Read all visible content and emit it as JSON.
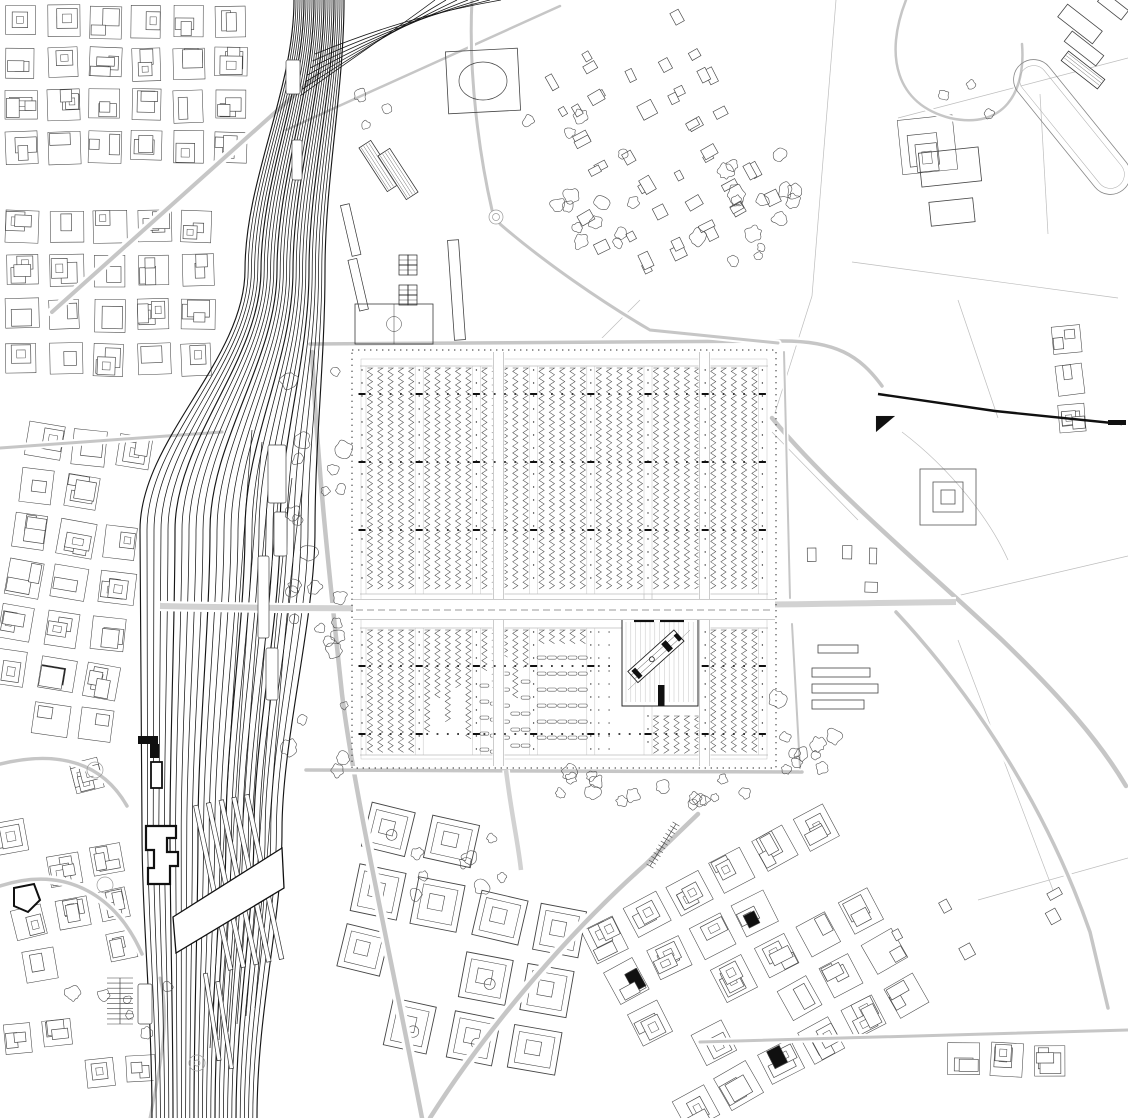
{
  "canvas": {
    "width": 1128,
    "height": 1118
  },
  "colors": {
    "background": "#ffffff",
    "ink": "#101010",
    "fabric": "#454545",
    "light": "#9a9a9a",
    "faint": "#bdbdbd",
    "road": "#c6c6c6",
    "band": "#d2d2d2",
    "rail": "#161616",
    "tree": "#4f4f4f",
    "strip": "#4a4a4a",
    "dot": "#2e2e2e"
  },
  "fields": [
    "M836,0 L812,296",
    "M812,296 L774,416",
    "M898,118 L1128,58",
    "M852,262 L1118,298",
    "M958,300 L998,418",
    "M948,598 L1128,556",
    "M958,640 L1056,898",
    "M978,900 L1128,858",
    "M1040,94 L1048,234",
    "M902,432 C952,470 990,520 1008,560",
    "M772,432 L858,520",
    "M600,340 L640,300",
    "M860,600 L948,598"
  ],
  "districts": [
    {
      "x": 0,
      "y": 0,
      "w": 285,
      "h": 200,
      "cell": 42,
      "gap": 9,
      "rot": 0,
      "seed": 11,
      "density": 0.96,
      "style": "block"
    },
    {
      "x": 0,
      "y": 205,
      "w": 240,
      "h": 215,
      "cell": 44,
      "gap": 10,
      "rot": 0,
      "seed": 22,
      "density": 0.94,
      "style": "block"
    },
    {
      "x": 0,
      "y": 425,
      "w": 175,
      "h": 330,
      "cell": 46,
      "gap": 10,
      "rot": 8,
      "seed": 33,
      "density": 0.95,
      "style": "block"
    },
    {
      "x": 0,
      "y": 758,
      "w": 148,
      "h": 250,
      "cell": 44,
      "gap": 12,
      "rot": -12,
      "seed": 44,
      "density": 0.72,
      "style": "block"
    },
    {
      "x": 0,
      "y": 1012,
      "w": 190,
      "h": 106,
      "cell": 40,
      "gap": 10,
      "rot": -4,
      "seed": 55,
      "density": 0.6,
      "style": "block"
    },
    {
      "x": 332,
      "y": 822,
      "w": 300,
      "h": 296,
      "cell": 62,
      "gap": 14,
      "rot": 12,
      "seed": 66,
      "density": 0.85,
      "style": "campus"
    },
    {
      "x": 620,
      "y": 842,
      "w": 300,
      "h": 276,
      "cell": 48,
      "gap": 11,
      "rot": -28,
      "seed": 77,
      "density": 0.8,
      "style": "block"
    },
    {
      "x": 548,
      "y": 26,
      "w": 214,
      "h": 252,
      "cell": 34,
      "gap": 9,
      "rot": -28,
      "seed": 88,
      "density": 0.8,
      "style": "houses"
    },
    {
      "x": 880,
      "y": 858,
      "w": 248,
      "h": 152,
      "cell": 52,
      "gap": 12,
      "rot": -30,
      "seed": 99,
      "density": 0.45,
      "style": "houses"
    },
    {
      "x": 896,
      "y": 1038,
      "w": 232,
      "h": 80,
      "cell": 44,
      "gap": 10,
      "rot": 2,
      "seed": 111,
      "density": 0.8,
      "style": "block"
    },
    {
      "x": 1052,
      "y": 318,
      "w": 76,
      "h": 152,
      "cell": 40,
      "gap": 9,
      "rot": -5,
      "seed": 122,
      "density": 0.85,
      "style": "block"
    },
    {
      "x": 822,
      "y": 40,
      "w": 162,
      "h": 262,
      "cell": 72,
      "gap": 16,
      "rot": -8,
      "seed": 133,
      "density": 0.5,
      "style": "block"
    },
    {
      "x": 800,
      "y": 540,
      "w": 92,
      "h": 70,
      "cell": 30,
      "gap": 8,
      "rot": 0,
      "seed": 144,
      "density": 0.6,
      "style": "houses"
    }
  ],
  "roads": [
    {
      "d": "M52,312 L318,74",
      "w": 4
    },
    {
      "d": "M310,344 L778,341 C836,340 860,356 882,386",
      "w": 3.5
    },
    {
      "d": "M312,352 C318,470 328,562 342,694 C354,792 392,962 422,1118",
      "w": 4.5
    },
    {
      "d": "M306,770 L802,772",
      "w": 3.5
    },
    {
      "d": "M772,418 C828,486 916,560 1002,640 C1062,698 1100,742 1126,786",
      "w": 4.5
    },
    {
      "d": "M896,612 C978,700 1048,812 1090,932 L1108,1008",
      "w": 3.5
    },
    {
      "d": "M430,1118 C478,1042 558,942 646,864 L698,814",
      "w": 4.5
    },
    {
      "d": "M560,6 L286,130",
      "w": 2.5
    },
    {
      "d": "M906,0 C884,56 896,104 950,118 C1004,130 1026,92 1022,44",
      "w": 2.5
    },
    {
      "d": "M500,224 C544,262 602,302 650,330 L778,343",
      "w": 3
    },
    {
      "d": "M492,210 C480,158 468,76 472,0",
      "w": 3
    },
    {
      "d": "M700,1042 L1128,1030",
      "w": 3
    },
    {
      "d": "M0,764 C58,750 102,762 127,806",
      "w": 3.5
    },
    {
      "d": "M0,886 C68,864 118,898 142,954",
      "w": 3.5
    },
    {
      "d": "M150,1118 C162,1058 170,1016 160,978",
      "w": 3
    },
    {
      "d": "M784,352 L790,598",
      "w": 2
    },
    {
      "d": "M792,624 L800,768",
      "w": 2
    },
    {
      "d": "M0,448 L222,432",
      "w": 3
    }
  ],
  "roads_overlay": [
    {
      "d": "M160,606 C420,612 700,605 956,602",
      "w": 6
    },
    {
      "d": "M506,770 C512,818 518,842 521,870",
      "w": 4.5
    }
  ],
  "railway": {
    "count": 26,
    "ys": [
      0,
      270,
      530,
      830,
      1118
    ],
    "x": [
      [
        294,
        2.0
      ],
      [
        245,
        3.2
      ],
      [
        140,
        7.0
      ],
      [
        142,
        5.6
      ],
      [
        152,
        4.2
      ]
    ],
    "branch_count": 7,
    "sidings": 6
  },
  "platforms": {
    "groups": [
      {
        "rot": -12,
        "cx": 240,
        "cy": 880,
        "rects": [
          [
            210,
            798,
            4.5,
            168
          ],
          [
            223,
            798,
            4.5,
            168
          ],
          [
            236,
            798,
            4.5,
            168
          ],
          [
            249,
            798,
            4.5,
            168
          ],
          [
            262,
            798,
            4.5,
            168
          ]
        ]
      },
      {
        "rot": -9,
        "cx": 218,
        "cy": 1015,
        "rects": [
          [
            210,
            972,
            4,
            88
          ],
          [
            221,
            982,
            4,
            88
          ]
        ]
      },
      {
        "rot": -13,
        "cx": 358,
        "cy": 255,
        "rects": [
          [
            352,
            203,
            9,
            52
          ],
          [
            347,
            258,
            9,
            52
          ]
        ]
      }
    ]
  },
  "station": {
    "outline": "M146,826 L176,826 L176,838 L167,838 L167,852 L178,852 L178,866 L170,866 L170,884 L148,884 L148,868 L154,868 L154,850 L146,850 Z",
    "black_rects": [
      [
        138,
        736,
        20,
        8
      ],
      [
        150,
        744,
        9,
        14
      ]
    ],
    "bar": [
      151,
      762,
      11,
      26
    ],
    "pentagon": "M14,888 L34,884 L40,900 L28,912 L14,906 Z"
  },
  "deck": {
    "poly": "M173,917 L282,848 L284,888 L176,953 Z"
  },
  "thin_buildings": [
    [
      268,
      445,
      18,
      58
    ],
    [
      274,
      512,
      13,
      44
    ],
    [
      258,
      556,
      11,
      82
    ],
    [
      266,
      648,
      12,
      52
    ],
    [
      286,
      60,
      14,
      34
    ],
    [
      292,
      140,
      10,
      40
    ],
    [
      138,
      984,
      14,
      40
    ]
  ],
  "site": {
    "border": {
      "x": 352,
      "y": 350,
      "w": 424,
      "h": 418
    },
    "inner": {
      "x": 361,
      "y": 359,
      "w": 406,
      "h": 400
    },
    "band": {
      "y0": 599,
      "y1": 620
    },
    "upper": {
      "y0": 366,
      "y1": 594,
      "markers": [
        394,
        462,
        530
      ]
    },
    "lower": {
      "y0": 628,
      "y1": 755,
      "markers": [
        666,
        734
      ]
    },
    "cols": {
      "start": 370,
      "period": 57.2,
      "per": 5,
      "gap": 10.3
    },
    "lanes": [
      493,
      699
    ],
    "lower_groups": [
      "full",
      "stagger",
      "short",
      "beds",
      "dots",
      "plot",
      "full"
    ],
    "stagger_ends": [
      735,
      698,
      722,
      688,
      742
    ],
    "short_ends": [
      672,
      690,
      660,
      700,
      668
    ],
    "plot": {
      "x": 622,
      "y": 618,
      "w": 76,
      "h": 88,
      "bars_top": [
        [
          634,
          618.5,
          20,
          3.6
        ],
        [
          660,
          618.5,
          24,
          3.6
        ]
      ],
      "bar_bottom": [
        658,
        685,
        6.5,
        21
      ],
      "line_step": 4.8,
      "diag": {
        "rot": -42,
        "cx": 657,
        "cy": 656,
        "rect": [
          625,
          648,
          62,
          15
        ],
        "blacks": [
          [
            628,
            650,
            5,
            11
          ],
          [
            668,
            650,
            6,
            11
          ],
          [
            683,
            652,
            4,
            8
          ]
        ],
        "circle": [
          651,
          655,
          2.5
        ]
      }
    }
  },
  "trees": [
    {
      "x": 288,
      "y": 355,
      "w": 58,
      "h": 416,
      "n": 26,
      "r0": 4,
      "r1": 9,
      "seed": 7
    },
    {
      "x": 520,
      "y": 772,
      "w": 258,
      "h": 34,
      "n": 16,
      "r0": 4,
      "r1": 8,
      "seed": 8
    },
    {
      "x": 772,
      "y": 698,
      "w": 72,
      "h": 84,
      "n": 10,
      "r0": 4,
      "r1": 9,
      "seed": 9
    },
    {
      "x": 520,
      "y": 95,
      "w": 122,
      "h": 160,
      "n": 14,
      "r0": 4,
      "r1": 9,
      "seed": 10
    },
    {
      "x": 688,
      "y": 148,
      "w": 112,
      "h": 118,
      "n": 10,
      "r0": 4,
      "r1": 10,
      "seed": 21
    },
    {
      "x": 348,
      "y": 92,
      "w": 44,
      "h": 44,
      "n": 3,
      "r0": 4,
      "r1": 8,
      "seed": 12
    },
    {
      "x": 60,
      "y": 978,
      "w": 120,
      "h": 60,
      "n": 6,
      "r0": 4,
      "r1": 8,
      "seed": 13
    },
    {
      "x": 415,
      "y": 836,
      "w": 112,
      "h": 62,
      "n": 8,
      "r0": 4,
      "r1": 8,
      "seed": 14
    },
    {
      "x": 928,
      "y": 78,
      "w": 64,
      "h": 42,
      "n": 3,
      "r0": 4,
      "r1": 8,
      "seed": 15
    },
    {
      "x": 760,
      "y": 180,
      "w": 40,
      "h": 70,
      "n": 5,
      "r0": 4,
      "r1": 9,
      "seed": 16
    }
  ],
  "landmarks": {
    "rects": [
      {
        "x": 812,
        "y": 668,
        "w": 58,
        "h": 9
      },
      {
        "x": 812,
        "y": 684,
        "w": 66,
        "h": 9
      },
      {
        "x": 812,
        "y": 700,
        "w": 52,
        "h": 9
      },
      {
        "x": 818,
        "y": 645,
        "w": 40,
        "h": 8
      },
      {
        "x": 1058,
        "y": 16,
        "w": 44,
        "h": 16,
        "rot": 38
      },
      {
        "x": 1064,
        "y": 42,
        "w": 40,
        "h": 13,
        "rot": 38
      },
      {
        "x": 1098,
        "y": 0,
        "w": 30,
        "h": 12,
        "rot": 38
      },
      {
        "x": 447,
        "y": 50,
        "w": 72,
        "h": 62,
        "rot": -3
      },
      {
        "x": 451,
        "y": 240,
        "w": 11,
        "h": 100,
        "rot": -4
      },
      {
        "x": 1108,
        "y": 420,
        "w": 18,
        "h": 5,
        "fill": "#101010"
      },
      {
        "x": 920,
        "y": 150,
        "w": 60,
        "h": 34,
        "rot": -6
      },
      {
        "x": 930,
        "y": 200,
        "w": 44,
        "h": 24,
        "rot": -6
      }
    ],
    "paths": [
      {
        "d": "M878,394 L995,411 L1122,424",
        "w": 2.4,
        "stroke": "#101010"
      },
      {
        "d": "M876,416 L895,416 L876,432 Z",
        "fill": "#101010",
        "w": 0.1
      }
    ],
    "circles": [
      {
        "x": 496,
        "y": 217,
        "r": 7
      },
      {
        "x": 496,
        "y": 217,
        "r": 3.5
      },
      {
        "x": 197,
        "y": 1063,
        "r": 8
      },
      {
        "x": 197,
        "y": 1063,
        "r": 3
      },
      {
        "x": 95,
        "y": 770,
        "r": 8
      },
      {
        "x": 105,
        "y": 885,
        "r": 8
      }
    ],
    "hatched": [
      {
        "x": 372,
        "y": 140,
        "w": 14,
        "h": 52,
        "rot": -33,
        "step": 3
      },
      {
        "x": 391,
        "y": 148,
        "w": 14,
        "h": 52,
        "rot": -33,
        "step": 3
      },
      {
        "x": 1060,
        "y": 64,
        "w": 46,
        "h": 12,
        "rot": 38,
        "step": 3
      }
    ],
    "courts": [
      {
        "x": 399,
        "y": 255,
        "cw": 9,
        "ch": 10
      },
      {
        "x": 399,
        "y": 285,
        "cw": 9,
        "ch": 10
      }
    ],
    "pitch": {
      "x": 355,
      "y": 304,
      "w": 78,
      "h": 40
    },
    "stadium_ellipse": {
      "x": 483,
      "y": 81,
      "rx": 24,
      "ry": 19
    },
    "concentric": {
      "x": 948,
      "y": 497,
      "sizes": [
        56,
        30,
        14
      ]
    },
    "enclosure": {
      "x": 1072,
      "y": 127,
      "w": 162,
      "h": 40,
      "rot": 51
    },
    "ticked": [
      {
        "x1": 650,
        "y1": 866,
        "x2": 676,
        "y2": 824,
        "n": 11,
        "len": 8
      },
      {
        "x1": 120,
        "y1": 978,
        "x2": 120,
        "y2": 1024,
        "n": 9,
        "len": 26
      }
    ]
  }
}
